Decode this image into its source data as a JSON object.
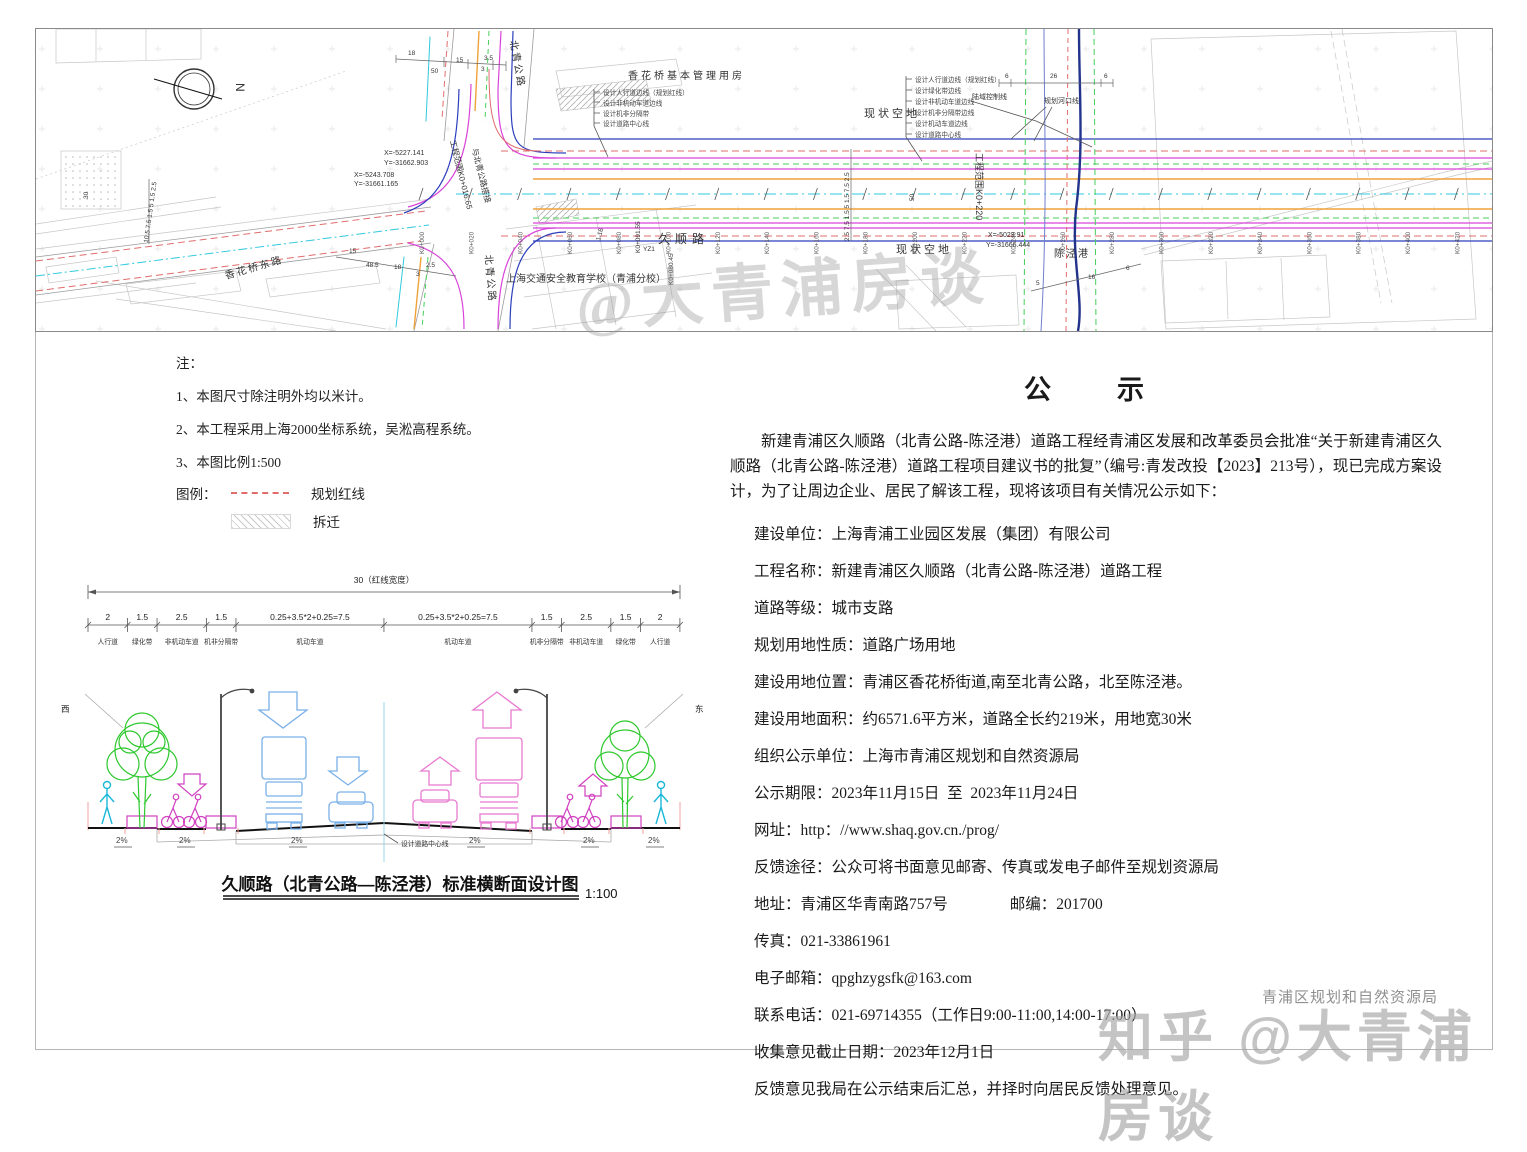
{
  "map": {
    "building_top": "香花桥基本管理用房",
    "vacant1": "现状空地",
    "vacant2": "现状空地",
    "road_main": "久顺路",
    "road_north_top": "北青公路",
    "road_north_bottom": "北青公路",
    "road_east": "香花桥东路",
    "river": "陈泾港",
    "school": "上海交通安全教育学校（青浦分校）",
    "scope_start1": "工程范围K0+016.65",
    "scope_start2": "与北青公路搭接",
    "scope_end": "工程范围K0+220",
    "line_river": "规划河口线",
    "line_land": "陆域控制线",
    "c1x": "X=-5227.141",
    "c1y": "Y=-31662.903",
    "c2x": "X=-5243.708",
    "c2y": "Y=-31661.165",
    "c3x": "X=-5023.91",
    "c3y": "Y=-31666.444",
    "sta_a": "K0+091.55",
    "sta_b": "K0+080.45",
    "yz1": "YZ1",
    "north": "N",
    "callouts_left": [
      "设计人行道边线（规划红线）",
      "设计非机动车道边线",
      "设计机非分隔带",
      "设计道路中心线"
    ],
    "callouts_right": [
      "设计人行道边线（规划红线）",
      "设计绿化带边线",
      "设计非机动车道边线",
      "设计机非分隔带边线",
      "设计机动车道边线",
      "设计道路中心线"
    ],
    "stations": [
      "K0+000",
      "K0+020",
      "K0+040",
      "K0+060",
      "K0+080",
      "K0+100",
      "K0+120",
      "K0+140",
      "K0+160",
      "K0+180",
      "K0+200",
      "K0+220",
      "K0+240",
      "K0+260",
      "K0+280",
      "K0+300",
      "K0+320",
      "K0+340",
      "K0+360",
      "K0+380",
      "K0+400",
      "K0+420"
    ],
    "dims": {
      "top1": "18",
      "top2": "50",
      "top3": "15",
      "top4": "3.5",
      "top5": "3",
      "bot1": "15",
      "bot2": "48.5",
      "bot3": "18",
      "bot4": "3",
      "bot5": "2.5",
      "d116": "1.16",
      "w30": "30",
      "w50": "50",
      "r6a": "6",
      "r26": "26",
      "r6b": "6",
      "rb5": "5",
      "rb16": "16",
      "rb6": "6",
      "stackmid": "2.5 7.5 1.5 5 1.5 7.5 2.5",
      "stackleft": "10.5 7.5 1.5 5 1.5 2.5"
    }
  },
  "notes": {
    "heading": "注：",
    "items": [
      "1、本图尺寸除注明外均以米计。",
      "2、本工程采用上海2000坐标系统，吴淞高程系统。",
      "3、本图比例1:500"
    ],
    "legend": "图例：",
    "legend_redline": "规划红线",
    "legend_demolish": "拆迁"
  },
  "cs": {
    "total": "30（红线宽度）",
    "west": "西",
    "east": "东",
    "slope": "2%",
    "center": "设计道路中心线",
    "title": "久顺路（北青公路—陈泾港）标准横断面设计图",
    "scale": "1:100",
    "segments": [
      {
        "dim": "2",
        "label": "人行道",
        "width_m": 2
      },
      {
        "dim": "1.5",
        "label": "绿化带",
        "width_m": 1.5
      },
      {
        "dim": "2.5",
        "label": "非机动车道",
        "width_m": 2.5
      },
      {
        "dim": "1.5",
        "label": "机非分隔带",
        "width_m": 1.5
      },
      {
        "dim": "0.25+3.5*2+0.25=7.5",
        "label": "机动车道",
        "width_m": 7.5
      },
      {
        "dim": "0.25+3.5*2+0.25=7.5",
        "label": "机动车道",
        "width_m": 7.5
      },
      {
        "dim": "1.5",
        "label": "机非分隔带",
        "width_m": 1.5
      },
      {
        "dim": "2.5",
        "label": "非机动车道",
        "width_m": 2.5
      },
      {
        "dim": "1.5",
        "label": "绿化带",
        "width_m": 1.5
      },
      {
        "dim": "2",
        "label": "人行道",
        "width_m": 2
      }
    ]
  },
  "notice": {
    "title": "公　　示",
    "intro": "新建青浦区久顺路（北青公路-陈泾港）道路工程经青浦区发展和改革委员会批准“关于新建青浦区久顺路（北青公路-陈泾港）道路工程项目建议书的批复”（编号:青发改投【2023】213号），现已完成方案设计，为了让周边企业、居民了解该工程，现将该项目有关情况公示如下：",
    "items": [
      "建设单位：上海青浦工业园区发展（集团）有限公司",
      "工程名称：新建青浦区久顺路（北青公路-陈泾港）道路工程",
      "道路等级：城市支路",
      "规划用地性质：道路广场用地",
      "建设用地位置：青浦区香花桥街道,南至北青公路，北至陈泾港。",
      "建设用地面积：约6571.6平方米，道路全长约219米，用地宽30米",
      "组织公示单位：上海市青浦区规划和自然资源局",
      "公示期限：2023年11月15日  至  2023年11月24日",
      "网址：http：//www.shaq.gov.cn./prog/",
      "反馈途径：公众可将书面意见邮寄、传真或发电子邮件至规划资源局",
      "地址：青浦区华青南路757号　　　　邮编：201700",
      "传真：021-33861961",
      "电子邮箱：qpghzygsfk@163.com",
      "联系电话：021-69714355（工作日9:00-11:00,14:00-17:00）",
      "收集意见截止日期：2023年12月1日",
      "反馈意见我局在公示结束后汇总，并择时向居民反馈处理意见。"
    ]
  },
  "wm": {
    "map": "@大青浦房谈",
    "zhihu": "知乎 @大青浦房谈",
    "stamp": "青浦区规划和自然资源局"
  }
}
